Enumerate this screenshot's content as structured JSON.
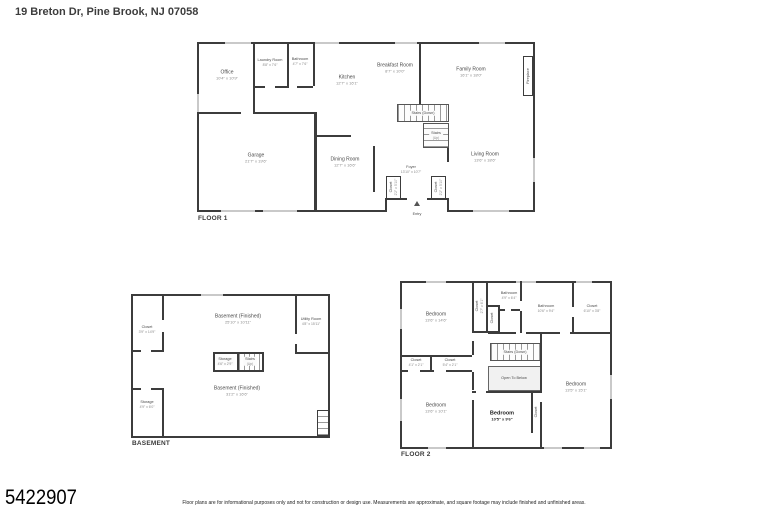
{
  "page": {
    "title": "19 Breton Dr, Pine Brook, NJ 07058",
    "listing_number": "5422907",
    "disclaimer": "Floor plans are for informational purposes only and not for construction or design use. Measurements are approximate, and square footage may include finished and unfinished areas."
  },
  "colors": {
    "wall": "#3c3c3c",
    "window": "#c9c9c9",
    "room_name": "#4a4a4a",
    "room_dims": "#8a8a8a"
  },
  "floors": [
    {
      "id": "floor1",
      "label": "FLOOR 1",
      "rooms": [
        {
          "name": "Office",
          "dims": "10'4\" x 10'9\"",
          "x": 30,
          "y": 33
        },
        {
          "name": "Laundry Room",
          "dims": "8'8\" x 7'6\"",
          "x": 73,
          "y": 20,
          "small": true
        },
        {
          "name": "Bathroom",
          "dims": "4'7\" x 7'6\"",
          "x": 103,
          "y": 19,
          "small": true
        },
        {
          "name": "Kitchen",
          "dims": "12'7\" x 16'1\"",
          "x": 150,
          "y": 38
        },
        {
          "name": "Breakfast Room",
          "dims": "8'7\" x 10'0\"",
          "x": 198,
          "y": 26
        },
        {
          "name": "Family Room",
          "dims": "16'1\" x 18'0\"",
          "x": 274,
          "y": 30
        },
        {
          "name": "Fireplace",
          "x": 331,
          "y": 34,
          "vertical": true,
          "small": true
        },
        {
          "name": "Stairs (Down)",
          "x": 226,
          "y": 71,
          "small": true,
          "chip": true
        },
        {
          "name": "Stairs",
          "dims": "(Up)",
          "x": 239,
          "y": 93,
          "small": true,
          "chip": true
        },
        {
          "name": "Garage",
          "dims": "21'7\" x 19'6\"",
          "x": 59,
          "y": 116
        },
        {
          "name": "Dining Room",
          "dims": "12'7\" x 16'6\"",
          "x": 148,
          "y": 120
        },
        {
          "name": "Foyer",
          "dims": "13'10\" x 10'7\"",
          "x": 214,
          "y": 127,
          "small": true
        },
        {
          "name": "Living Room",
          "dims": "13'6\" x 18'6\"",
          "x": 288,
          "y": 115
        },
        {
          "name": "Closet",
          "dims": "2'2\" x 5'10\"",
          "x": 196,
          "y": 145,
          "vertical": true,
          "small": true
        },
        {
          "name": "Closet",
          "dims": "2'2\" x 5'10\"",
          "x": 241,
          "y": 145,
          "vertical": true,
          "small": true
        },
        {
          "name": "Entry",
          "x": 220,
          "y": 172,
          "small": true
        }
      ]
    },
    {
      "id": "basement",
      "label": "BASEMENT",
      "rooms": [
        {
          "name": "Closet",
          "dims": "3'9\" x 14'9\"",
          "x": 16,
          "y": 35,
          "small": true
        },
        {
          "name": "Basement (Finished)",
          "dims": "25'10\" x 10'11\"",
          "x": 107,
          "y": 25
        },
        {
          "name": "Utility Room",
          "dims": "4'8\" x 15'11\"",
          "x": 180,
          "y": 27,
          "small": true
        },
        {
          "name": "Storage",
          "dims": "4'6\" x 2'9\"",
          "x": 94,
          "y": 67,
          "small": true,
          "chip": true
        },
        {
          "name": "Stairs",
          "dims": "(Up)",
          "x": 119,
          "y": 67,
          "small": true,
          "chip": true
        },
        {
          "name": "Basement (Finished)",
          "dims": "31'2\" x 16'6\"",
          "x": 106,
          "y": 97
        },
        {
          "name": "Storage",
          "dims": "4'9\" x 6'0\"",
          "x": 16,
          "y": 110,
          "small": true
        }
      ]
    },
    {
      "id": "floor2",
      "label": "FLOOR 2",
      "rooms": [
        {
          "name": "Bedroom",
          "dims": "13'6\" x 14'6\"",
          "x": 36,
          "y": 36
        },
        {
          "name": "Closet",
          "dims": "2'7\" x 6'1\"",
          "x": 79,
          "y": 25,
          "vertical": true,
          "small": true
        },
        {
          "name": "Closet",
          "x": 92,
          "y": 37,
          "vertical": true,
          "small": true
        },
        {
          "name": "Bathroom",
          "dims": "4'9\" x 6'4\"",
          "x": 109,
          "y": 14,
          "small": true
        },
        {
          "name": "Bathroom",
          "dims": "10'6\" x 9'4\"",
          "x": 146,
          "y": 27,
          "small": true
        },
        {
          "name": "Closet",
          "dims": "6'10\" x 3'8\"",
          "x": 192,
          "y": 27,
          "small": true
        },
        {
          "name": "Closet",
          "dims": "4'1\" x 2'1\"",
          "x": 16,
          "y": 81,
          "small": true
        },
        {
          "name": "Closet",
          "dims": "5'4\" x 2'1\"",
          "x": 50,
          "y": 81,
          "small": true
        },
        {
          "name": "Stairs (Down)",
          "x": 115,
          "y": 71,
          "small": true,
          "chip": true
        },
        {
          "name": "Open To Below",
          "x": 114,
          "y": 97,
          "small": true
        },
        {
          "name": "Bedroom",
          "dims": "13'5\" x 15'1\"",
          "x": 176,
          "y": 106
        },
        {
          "name": "Bedroom",
          "dims": "13'6\" x 10'1\"",
          "x": 36,
          "y": 127
        },
        {
          "name": "Bedroom",
          "dims": "10'5\" x 9'6\"",
          "x": 102,
          "y": 135,
          "bold": true
        },
        {
          "name": "Closet",
          "x": 136,
          "y": 131,
          "vertical": true,
          "small": true
        }
      ]
    }
  ]
}
